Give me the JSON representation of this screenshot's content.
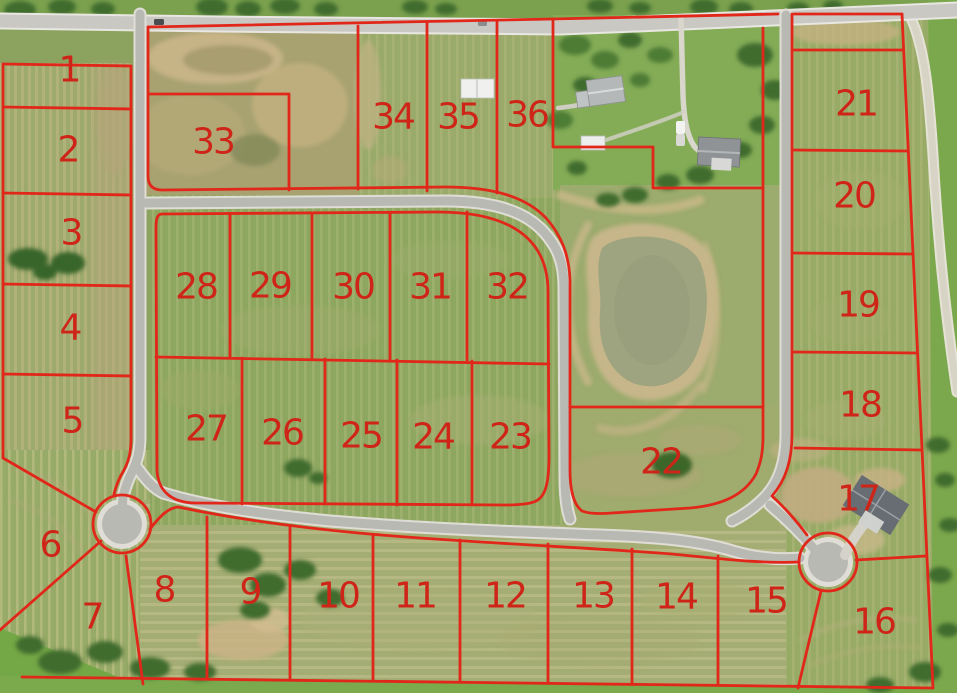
{
  "map": {
    "kind": "aerial plat map with numbered lots",
    "lot_count": 36,
    "colors": {
      "boundary_line": "#e1271a",
      "lot_number_text": "#cf2418",
      "road_asphalt": "#b9b9b4",
      "road_shoulder": "#dfddd5",
      "highway": "#c9c8c3",
      "grass_base": "#8ca25f",
      "pond_water": "#9fa480",
      "dirt": "#c6b386",
      "trees": "#3f6c2d"
    },
    "features": {
      "cul_de_sac_count": 2,
      "pond_count": 2
    },
    "lots": [
      {
        "number": "1",
        "x": 69,
        "y": 70
      },
      {
        "number": "2",
        "x": 68,
        "y": 150
      },
      {
        "number": "3",
        "x": 71,
        "y": 233
      },
      {
        "number": "4",
        "x": 70,
        "y": 328
      },
      {
        "number": "5",
        "x": 72,
        "y": 421
      },
      {
        "number": "6",
        "x": 50,
        "y": 545
      },
      {
        "number": "7",
        "x": 92,
        "y": 617
      },
      {
        "number": "8",
        "x": 164,
        "y": 590
      },
      {
        "number": "9",
        "x": 250,
        "y": 592
      },
      {
        "number": "10",
        "x": 338,
        "y": 596
      },
      {
        "number": "11",
        "x": 415,
        "y": 596
      },
      {
        "number": "12",
        "x": 505,
        "y": 596
      },
      {
        "number": "13",
        "x": 593,
        "y": 596
      },
      {
        "number": "14",
        "x": 676,
        "y": 597
      },
      {
        "number": "15",
        "x": 766,
        "y": 601
      },
      {
        "number": "16",
        "x": 874,
        "y": 622
      },
      {
        "number": "17",
        "x": 858,
        "y": 499
      },
      {
        "number": "18",
        "x": 860,
        "y": 405
      },
      {
        "number": "19",
        "x": 858,
        "y": 305
      },
      {
        "number": "20",
        "x": 854,
        "y": 196
      },
      {
        "number": "21",
        "x": 856,
        "y": 104
      },
      {
        "number": "22",
        "x": 661,
        "y": 462
      },
      {
        "number": "23",
        "x": 510,
        "y": 437
      },
      {
        "number": "24",
        "x": 433,
        "y": 437
      },
      {
        "number": "25",
        "x": 361,
        "y": 436
      },
      {
        "number": "26",
        "x": 282,
        "y": 433
      },
      {
        "number": "27",
        "x": 206,
        "y": 429
      },
      {
        "number": "28",
        "x": 196,
        "y": 287
      },
      {
        "number": "29",
        "x": 270,
        "y": 286
      },
      {
        "number": "30",
        "x": 353,
        "y": 287
      },
      {
        "number": "31",
        "x": 430,
        "y": 287
      },
      {
        "number": "32",
        "x": 507,
        "y": 287
      },
      {
        "number": "33",
        "x": 213,
        "y": 142
      },
      {
        "number": "34",
        "x": 393,
        "y": 117
      },
      {
        "number": "35",
        "x": 458,
        "y": 117
      },
      {
        "number": "36",
        "x": 527,
        "y": 115
      }
    ]
  }
}
